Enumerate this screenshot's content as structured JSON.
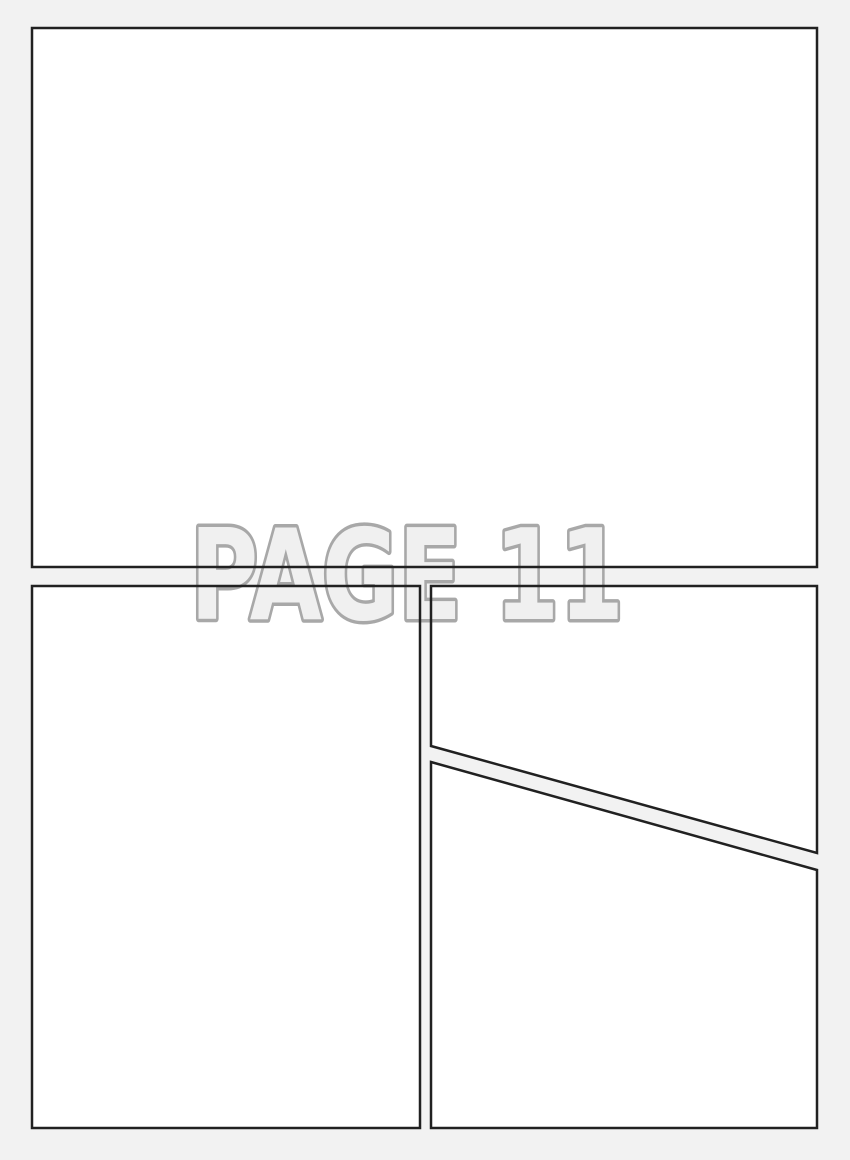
{
  "page": {
    "watermark_text": "PAGE 11",
    "colors": {
      "background": "#f2f2f2",
      "panel_fill": "#ffffff",
      "panel_border": "#212121",
      "watermark_fill": "#f0f0f0",
      "watermark_outline": "#a8a8a8"
    }
  }
}
